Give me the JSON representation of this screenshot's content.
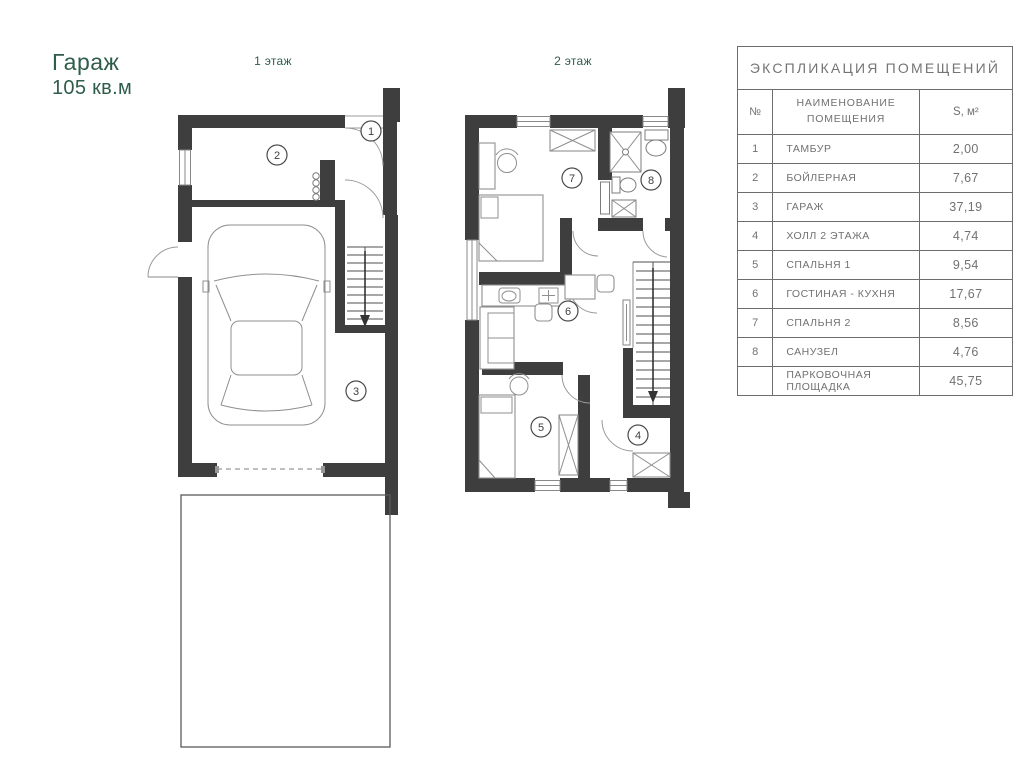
{
  "header": {
    "title_line1": "Гараж",
    "title_line2": "105 кв.м",
    "floor1_label": "1 этаж",
    "floor2_label": "2 этаж"
  },
  "colors": {
    "accent_green": "#2F5D4B",
    "wall_dark": "#3E3E3E",
    "table_text": "#717171"
  },
  "plans": {
    "floor1": {
      "room_numbers": [
        "1",
        "2",
        "3"
      ]
    },
    "floor2": {
      "room_numbers": [
        "7",
        "8",
        "6",
        "5",
        "4"
      ]
    }
  },
  "table": {
    "title": "ЭКСПЛИКАЦИЯ ПОМЕЩЕНИЙ",
    "col_num": "№",
    "col_name_line1": "НАИМЕНОВАНИЕ",
    "col_name_line2": "ПОМЕЩЕНИЯ",
    "col_area": "S, м²",
    "rows": [
      {
        "num": "1",
        "name": "ТАМБУР",
        "area": "2,00"
      },
      {
        "num": "2",
        "name": "БОЙЛЕРНАЯ",
        "area": "7,67"
      },
      {
        "num": "3",
        "name": "ГАРАЖ",
        "area": "37,19"
      },
      {
        "num": "4",
        "name": "ХОЛЛ 2 ЭТАЖА",
        "area": "4,74"
      },
      {
        "num": "5",
        "name": "СПАЛЬНЯ 1",
        "area": "9,54"
      },
      {
        "num": "6",
        "name": "ГОСТИНАЯ - КУХНЯ",
        "area": "17,67"
      },
      {
        "num": "7",
        "name": "СПАЛЬНЯ 2",
        "area": "8,56"
      },
      {
        "num": "8",
        "name": "САНУЗЕЛ",
        "area": "4,76"
      },
      {
        "num": "",
        "name": "ПАРКОВОЧНАЯ ПЛОЩАДКА",
        "area": "45,75"
      }
    ]
  }
}
